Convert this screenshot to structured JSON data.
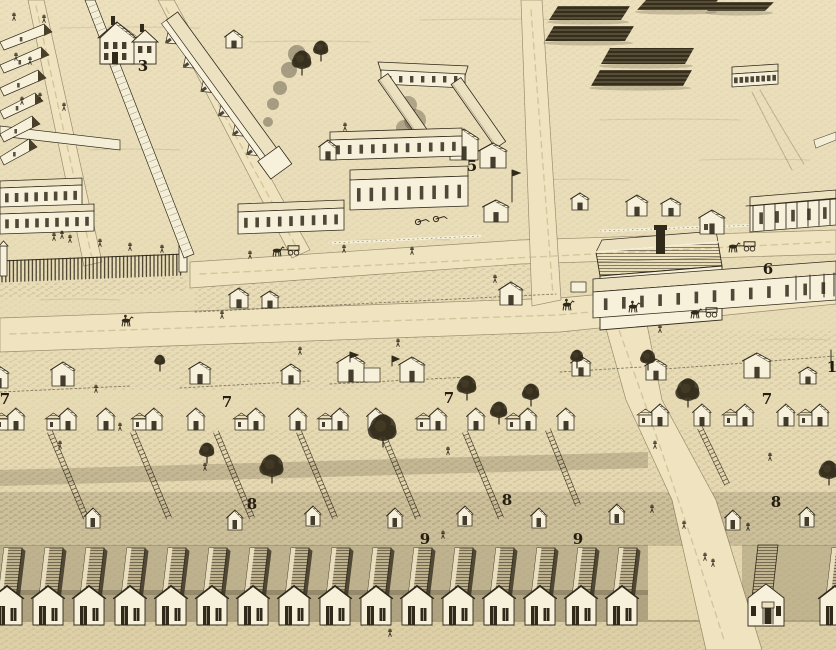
{
  "map": {
    "palette": {
      "paper": "#e8dcb8",
      "street": "#efe4bf",
      "ink": "#312a1b",
      "building_face": "#f7f1dc",
      "roof_light": "#ece2c2",
      "shadow": "#3a3226",
      "foliage": "#352d1c"
    },
    "labels": [
      {
        "text": "3",
        "x": 143,
        "y": 67
      },
      {
        "text": "5",
        "x": 472,
        "y": 167
      },
      {
        "text": "6",
        "x": 768,
        "y": 270
      },
      {
        "text": "7",
        "x": 5,
        "y": 400,
        "partial": true
      },
      {
        "text": "7",
        "x": 227,
        "y": 403
      },
      {
        "text": "7",
        "x": 449,
        "y": 399
      },
      {
        "text": "7",
        "x": 767,
        "y": 400
      },
      {
        "text": "8",
        "x": 252,
        "y": 505,
        "partial": true
      },
      {
        "text": "8",
        "x": 507,
        "y": 501
      },
      {
        "text": "8",
        "x": 776,
        "y": 503
      },
      {
        "text": "9",
        "x": 425,
        "y": 540
      },
      {
        "text": "9",
        "x": 578,
        "y": 540
      },
      {
        "text": "1",
        "x": 832,
        "y": 368,
        "partial": true
      }
    ]
  }
}
